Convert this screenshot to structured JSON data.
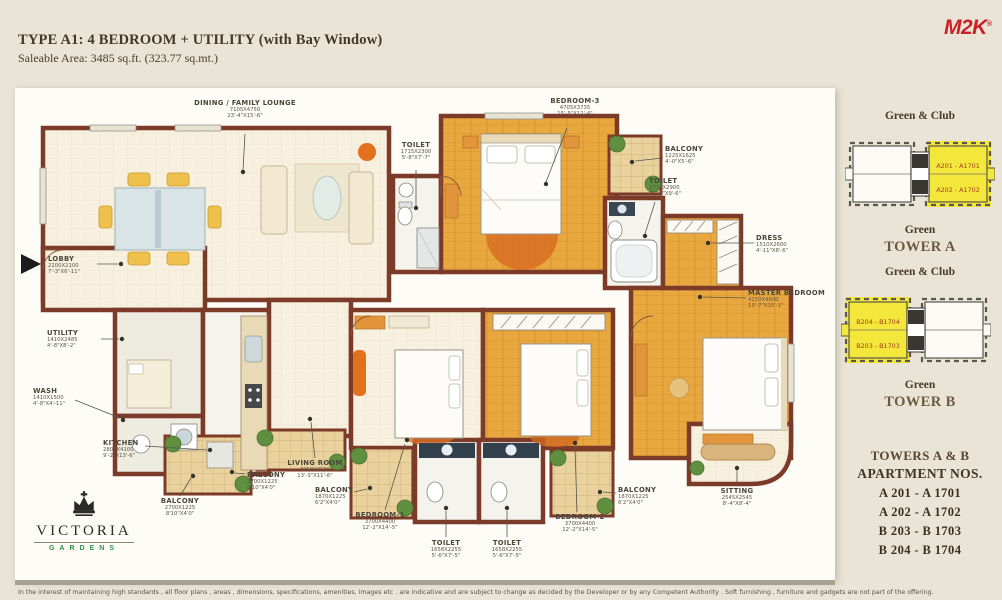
{
  "header": {
    "title": "TYPE A1: 4 BEDROOM + UTILITY (with Bay Window)",
    "subtitle": "Saleable Area: 3485 sq.ft. (323.77 sq.mt.)",
    "brand": "M2K"
  },
  "plan": {
    "labels": [
      {
        "name": "DINING / FAMILY LOUNGE",
        "mm": "7105X4750",
        "ft": "23'-4\"X15'-6\""
      },
      {
        "name": "TOILET",
        "mm": "1715X2300",
        "ft": "5'-8\"X7'-7\""
      },
      {
        "name": "BEDROOM-3",
        "mm": "4705X3735",
        "ft": "15'-5\"X12'-4\""
      },
      {
        "name": "BALCONY",
        "mm": "1225X1625",
        "ft": "4'-0\"X5'-6\""
      },
      {
        "name": "TOILET",
        "mm": "2730X2900",
        "ft": "8'-11\"X9'-6\""
      },
      {
        "name": "DRESS",
        "mm": "1510X2600",
        "ft": "4'-11\"X8'-6\""
      },
      {
        "name": "MASTER BEDROOM",
        "mm": "4150X4600",
        "ft": "13'-7\"X15'-1\""
      },
      {
        "name": "LOBBY",
        "mm": "2200X2100",
        "ft": "7'-3\"X6'-11\""
      },
      {
        "name": "UTILITY",
        "mm": "1410X2485",
        "ft": "4'-8\"X8'-2\""
      },
      {
        "name": "WASH",
        "mm": "1410X1500",
        "ft": "4'-8\"X4'-11\""
      },
      {
        "name": "KITCHEN",
        "mm": "2800X4100",
        "ft": "9'-2\"X13'-6\""
      },
      {
        "name": "BALCONY",
        "mm": "2700X1225",
        "ft": "8'10\"X4'0\""
      },
      {
        "name": "BALCONY",
        "mm": "2700X1225",
        "ft": "8'10\"X4'0\""
      },
      {
        "name": "LIVING ROOM",
        "mm": "4050X3500",
        "ft": "13'-3\"X11'-6\""
      },
      {
        "name": "BALCONY",
        "mm": "1870X1225",
        "ft": "6'2\"X4'0\""
      },
      {
        "name": "BEDROOM-1",
        "mm": "3700X4400",
        "ft": "12'-2\"X14'-5\""
      },
      {
        "name": "TOILET",
        "mm": "1658X2255",
        "ft": "5'-6\"X7'-5\""
      },
      {
        "name": "TOILET",
        "mm": "1658X2255",
        "ft": "5'-6\"X7'-5\""
      },
      {
        "name": "BEDROOM-2",
        "mm": "3700X4400",
        "ft": "12'-2\"X14'-5\""
      },
      {
        "name": "BALCONY",
        "mm": "1870X1225",
        "ft": "6'2\"X4'0\""
      },
      {
        "name": "SITTING",
        "mm": "2545X2545",
        "ft": "8'-4\"X8'-4\""
      }
    ]
  },
  "sidebar": {
    "tower_a": {
      "top_label": "Green & Club",
      "bottom_label": "Green",
      "title": "TOWER A",
      "units": [
        "A201 - A1701",
        "A202 - A1702"
      ]
    },
    "tower_b": {
      "top_label": "Green & Club",
      "bottom_label": "Green",
      "title": "TOWER B",
      "units": [
        "B204 - B1704",
        "B203 - B1703"
      ]
    },
    "apartments": {
      "heading1": "TOWERS A & B",
      "heading2": "APARTMENT NOS.",
      "items": [
        "A 201 - A 1701",
        "A 202 - A 1702",
        "B 203 - B 1703",
        "B 204 - B 1704"
      ]
    }
  },
  "logo": {
    "name": "VICTORIA",
    "sub": "GARDENS"
  },
  "footer": {
    "disclaimer": "In the interest of maintaining high standards , all floor plans , areas , dimensions, specifications, amenities, images etc . are indicative and are subject to change as decided by the Developer or by any Competent Authority . Soft furnishing , furniture and gadgets are not part of the offering."
  },
  "colors": {
    "wall": "#7c3b28",
    "highlight": "#f2e73a",
    "brand_red": "#cb2026",
    "logo_green": "#2f9347"
  }
}
